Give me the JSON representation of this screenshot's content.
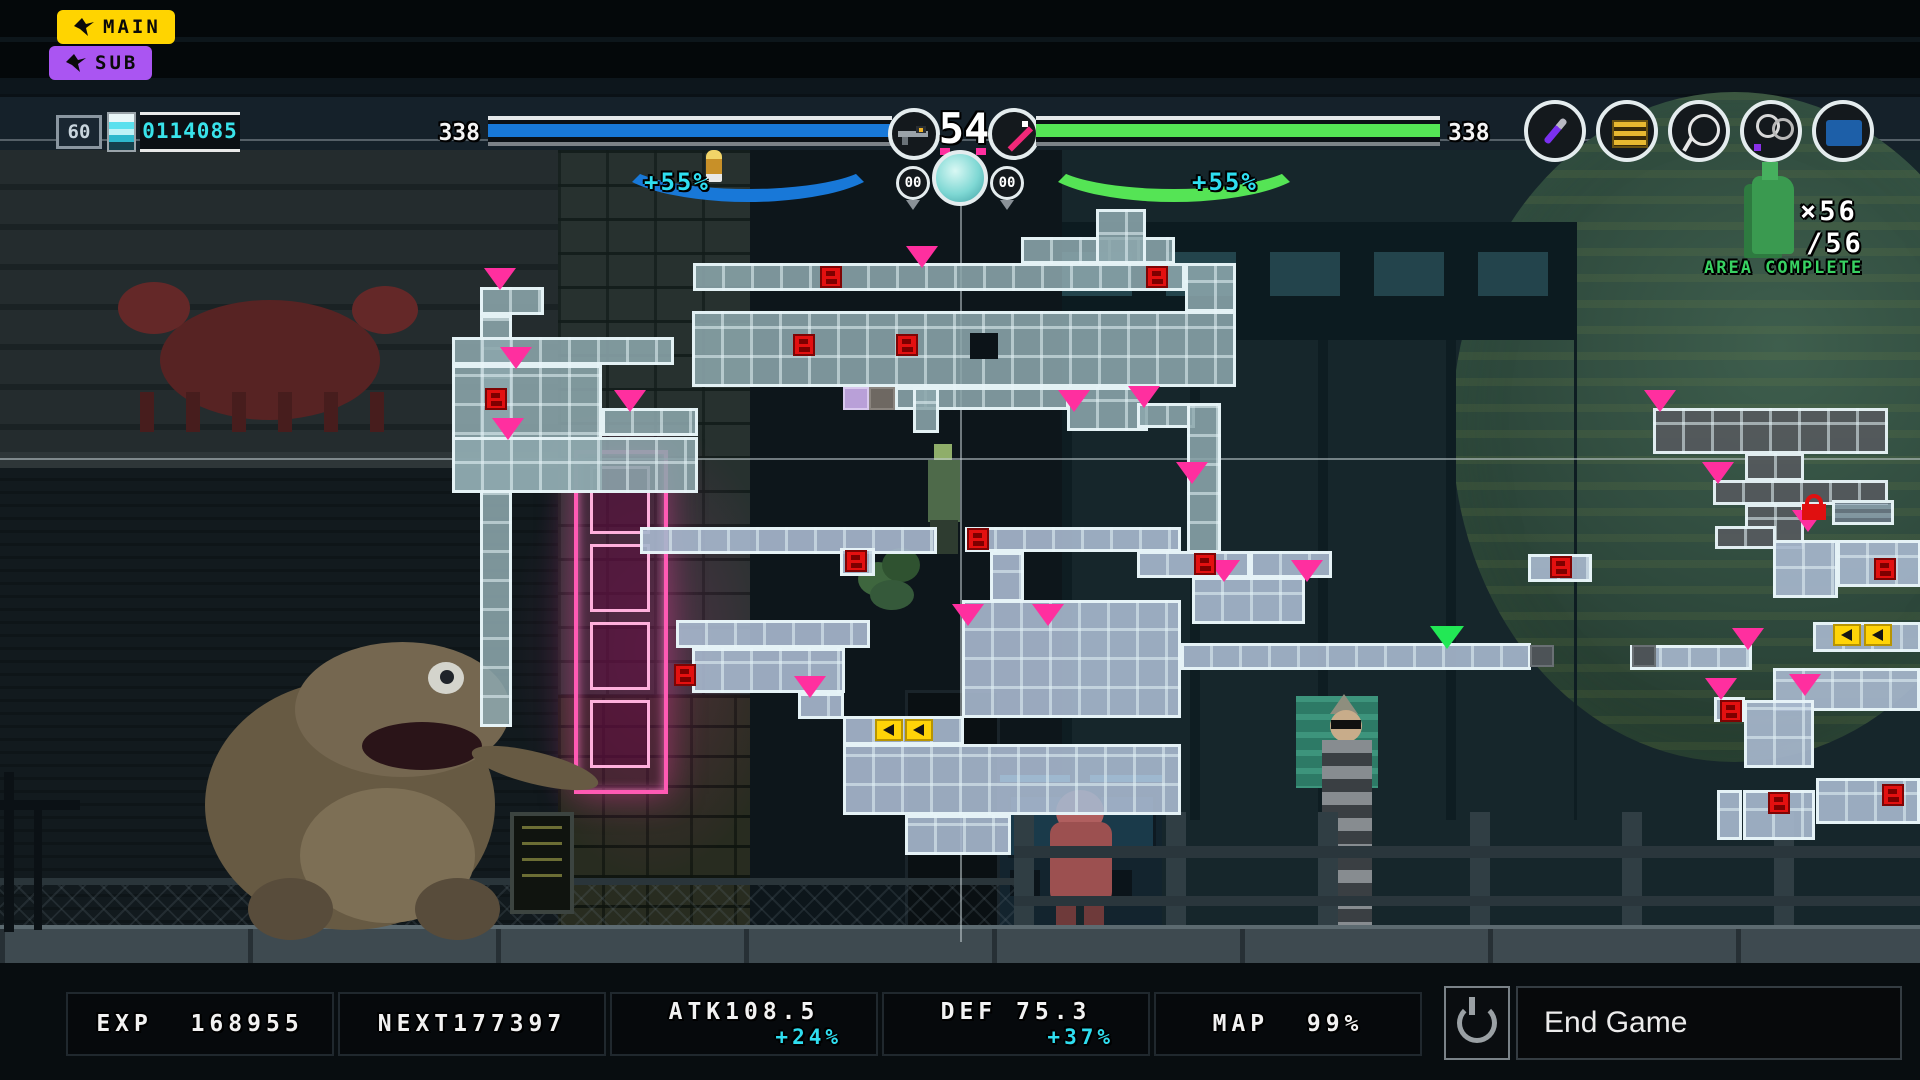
{
  "badges": {
    "main": "MAIN",
    "sub": "SUB"
  },
  "hud": {
    "fps": "60",
    "credits": "0114085",
    "left_bar": {
      "label": "338",
      "percent": 100,
      "buff": "+55%",
      "color": "#1878d8"
    },
    "right_bar": {
      "label": "338",
      "percent": 100,
      "buff": "+55%",
      "color": "#55e455"
    },
    "level": "54",
    "ammo_left": "00",
    "ammo_right": "00",
    "icons": [
      "bird-icon",
      "battery-icon",
      "bullet-icon",
      "gun-icon",
      "sword-icon",
      "energy-orb-icon",
      "dagger-item-icon",
      "gold-ticket-item-icon",
      "cable-loop-item-icon",
      "wire-loop-item-icon",
      "blue-card-item-icon",
      "bottle-icon",
      "power-icon"
    ],
    "colors": {
      "accent_cyan": "#2fdef0",
      "hp_blue": "#1878d8",
      "hp_green": "#55e455",
      "marker_pink": "#ff2f9f",
      "marker_green": "#22e855",
      "save_red": "#e31010",
      "door_yellow": "#ffd408",
      "badge_yellow": "#ffd400",
      "badge_purple": "#aa55f2"
    }
  },
  "area": {
    "count": "×56",
    "total": "/56",
    "label": "AREA COMPLETE"
  },
  "stats": {
    "exp": {
      "label": "EXP",
      "value": "168955"
    },
    "next": {
      "label": "NEXT",
      "value": "177397"
    },
    "atk": {
      "label": "ATK",
      "value": "108.5",
      "buff": "+24%"
    },
    "def": {
      "label": "DEF",
      "value": "75.3",
      "buff": "+37%"
    },
    "map": {
      "label": "MAP",
      "value": "99%"
    }
  },
  "end_game": {
    "label": "End Game"
  },
  "map": {
    "crosshair": {
      "x": 960,
      "y": 458,
      "v_top": 150,
      "v_bottom": 942
    },
    "rooms": [
      {
        "x": 480,
        "y": 287,
        "w": 64,
        "h": 28,
        "t": "a"
      },
      {
        "x": 480,
        "y": 315,
        "w": 32,
        "h": 412,
        "t": "a"
      },
      {
        "x": 452,
        "y": 337,
        "w": 222,
        "h": 28,
        "t": "a"
      },
      {
        "x": 452,
        "y": 365,
        "w": 150,
        "h": 128,
        "t": "a"
      },
      {
        "x": 602,
        "y": 408,
        "w": 96,
        "h": 28,
        "t": "a"
      },
      {
        "x": 452,
        "y": 437,
        "w": 246,
        "h": 56,
        "t": "a"
      },
      {
        "x": 693,
        "y": 263,
        "w": 492,
        "h": 28,
        "t": "a"
      },
      {
        "x": 1021,
        "y": 237,
        "w": 154,
        "h": 27,
        "t": "a"
      },
      {
        "x": 1096,
        "y": 209,
        "w": 50,
        "h": 55,
        "t": "a"
      },
      {
        "x": 1185,
        "y": 263,
        "w": 51,
        "h": 49,
        "t": "a"
      },
      {
        "x": 692,
        "y": 311,
        "w": 544,
        "h": 76,
        "t": "a"
      },
      {
        "x": 895,
        "y": 387,
        "w": 174,
        "h": 23,
        "t": "a"
      },
      {
        "x": 913,
        "y": 387,
        "w": 26,
        "h": 46,
        "t": "a"
      },
      {
        "x": 1067,
        "y": 387,
        "w": 81,
        "h": 44,
        "t": "a"
      },
      {
        "x": 1137,
        "y": 403,
        "w": 58,
        "h": 25,
        "t": "a"
      },
      {
        "x": 1187,
        "y": 403,
        "w": 34,
        "h": 150,
        "t": "a"
      },
      {
        "x": 640,
        "y": 527,
        "w": 297,
        "h": 27,
        "t": "b"
      },
      {
        "x": 840,
        "y": 548,
        "w": 35,
        "h": 28,
        "t": "b"
      },
      {
        "x": 965,
        "y": 527,
        "w": 216,
        "h": 25,
        "t": "b"
      },
      {
        "x": 990,
        "y": 552,
        "w": 34,
        "h": 50,
        "t": "b"
      },
      {
        "x": 676,
        "y": 620,
        "w": 194,
        "h": 28,
        "t": "b"
      },
      {
        "x": 692,
        "y": 648,
        "w": 153,
        "h": 45,
        "t": "b"
      },
      {
        "x": 798,
        "y": 693,
        "w": 46,
        "h": 26,
        "t": "b"
      },
      {
        "x": 843,
        "y": 716,
        "w": 121,
        "h": 29,
        "t": "b"
      },
      {
        "x": 962,
        "y": 600,
        "w": 219,
        "h": 118,
        "t": "b"
      },
      {
        "x": 843,
        "y": 744,
        "w": 338,
        "h": 71,
        "t": "b"
      },
      {
        "x": 905,
        "y": 815,
        "w": 106,
        "h": 40,
        "t": "b"
      },
      {
        "x": 1137,
        "y": 551,
        "w": 113,
        "h": 27,
        "t": "b"
      },
      {
        "x": 1250,
        "y": 551,
        "w": 82,
        "h": 27,
        "t": "b"
      },
      {
        "x": 1192,
        "y": 577,
        "w": 113,
        "h": 47,
        "t": "b"
      },
      {
        "x": 1181,
        "y": 643,
        "w": 350,
        "h": 27,
        "t": "b"
      },
      {
        "x": 1630,
        "y": 645,
        "w": 122,
        "h": 25,
        "t": "b"
      },
      {
        "x": 1528,
        "y": 554,
        "w": 64,
        "h": 28,
        "t": "b"
      },
      {
        "x": 1653,
        "y": 408,
        "w": 235,
        "h": 46,
        "t": "d"
      },
      {
        "x": 1745,
        "y": 453,
        "w": 59,
        "h": 28,
        "t": "d"
      },
      {
        "x": 1713,
        "y": 480,
        "w": 175,
        "h": 25,
        "t": "d"
      },
      {
        "x": 1745,
        "y": 504,
        "w": 59,
        "h": 45,
        "t": "d"
      },
      {
        "x": 1715,
        "y": 526,
        "w": 61,
        "h": 23,
        "t": "d"
      },
      {
        "x": 1832,
        "y": 500,
        "w": 62,
        "h": 25,
        "t": "s"
      },
      {
        "x": 1773,
        "y": 540,
        "w": 65,
        "h": 58,
        "t": "b"
      },
      {
        "x": 1837,
        "y": 540,
        "w": 84,
        "h": 47,
        "t": "b"
      },
      {
        "x": 1813,
        "y": 622,
        "w": 108,
        "h": 30,
        "t": "b"
      },
      {
        "x": 1773,
        "y": 668,
        "w": 147,
        "h": 43,
        "t": "b"
      },
      {
        "x": 1714,
        "y": 697,
        "w": 31,
        "h": 25,
        "t": "b"
      },
      {
        "x": 1744,
        "y": 700,
        "w": 70,
        "h": 68,
        "t": "b"
      },
      {
        "x": 1717,
        "y": 790,
        "w": 25,
        "h": 50,
        "t": "b"
      },
      {
        "x": 1743,
        "y": 790,
        "w": 72,
        "h": 50,
        "t": "b"
      },
      {
        "x": 1816,
        "y": 778,
        "w": 104,
        "h": 46,
        "t": "b"
      }
    ],
    "markers": [
      {
        "k": "pin",
        "x": 484,
        "y": 268
      },
      {
        "k": "pin",
        "x": 492,
        "y": 418
      },
      {
        "k": "pin",
        "x": 500,
        "y": 347
      },
      {
        "k": "pin",
        "x": 614,
        "y": 390
      },
      {
        "k": "pin",
        "x": 906,
        "y": 246
      },
      {
        "k": "pin",
        "x": 1058,
        "y": 390
      },
      {
        "k": "pin",
        "x": 794,
        "y": 676
      },
      {
        "k": "pin",
        "x": 952,
        "y": 604
      },
      {
        "k": "pin",
        "x": 1032,
        "y": 604
      },
      {
        "k": "pin",
        "x": 1128,
        "y": 386
      },
      {
        "k": "pin",
        "x": 1176,
        "y": 462
      },
      {
        "k": "pin",
        "x": 1208,
        "y": 560
      },
      {
        "k": "pin",
        "x": 1291,
        "y": 560
      },
      {
        "k": "pin",
        "x": 1644,
        "y": 390
      },
      {
        "k": "pin",
        "x": 1702,
        "y": 462
      },
      {
        "k": "pin",
        "x": 1792,
        "y": 510
      },
      {
        "k": "pin",
        "x": 1732,
        "y": 628
      },
      {
        "k": "pin",
        "x": 1789,
        "y": 674
      },
      {
        "k": "pin",
        "x": 1705,
        "y": 678
      },
      {
        "k": "gpin",
        "x": 1430,
        "y": 626
      },
      {
        "k": "save",
        "x": 485,
        "y": 388
      },
      {
        "k": "save",
        "x": 820,
        "y": 266
      },
      {
        "k": "save",
        "x": 1146,
        "y": 266
      },
      {
        "k": "save",
        "x": 793,
        "y": 334
      },
      {
        "k": "save",
        "x": 896,
        "y": 334
      },
      {
        "k": "save",
        "x": 845,
        "y": 550
      },
      {
        "k": "save",
        "x": 967,
        "y": 528
      },
      {
        "k": "save",
        "x": 1194,
        "y": 553
      },
      {
        "k": "save",
        "x": 1874,
        "y": 558
      },
      {
        "k": "save",
        "x": 1720,
        "y": 700
      },
      {
        "k": "save",
        "x": 1768,
        "y": 792
      },
      {
        "k": "save",
        "x": 1882,
        "y": 784
      },
      {
        "k": "save",
        "x": 1550,
        "y": 556
      },
      {
        "k": "save",
        "x": 674,
        "y": 664
      },
      {
        "k": "door",
        "x": 875,
        "y": 719
      },
      {
        "k": "door",
        "x": 905,
        "y": 719
      },
      {
        "k": "door",
        "x": 1833,
        "y": 624
      },
      {
        "k": "door",
        "x": 1864,
        "y": 624
      },
      {
        "k": "lock",
        "x": 1802,
        "y": 494
      },
      {
        "k": "purple",
        "x": 843,
        "y": 387
      },
      {
        "k": "gray",
        "x": 869,
        "y": 387
      },
      {
        "k": "hole",
        "x": 970,
        "y": 333
      },
      {
        "k": "capd",
        "x": 1530,
        "y": 645
      },
      {
        "k": "capd",
        "x": 1632,
        "y": 645
      }
    ]
  }
}
